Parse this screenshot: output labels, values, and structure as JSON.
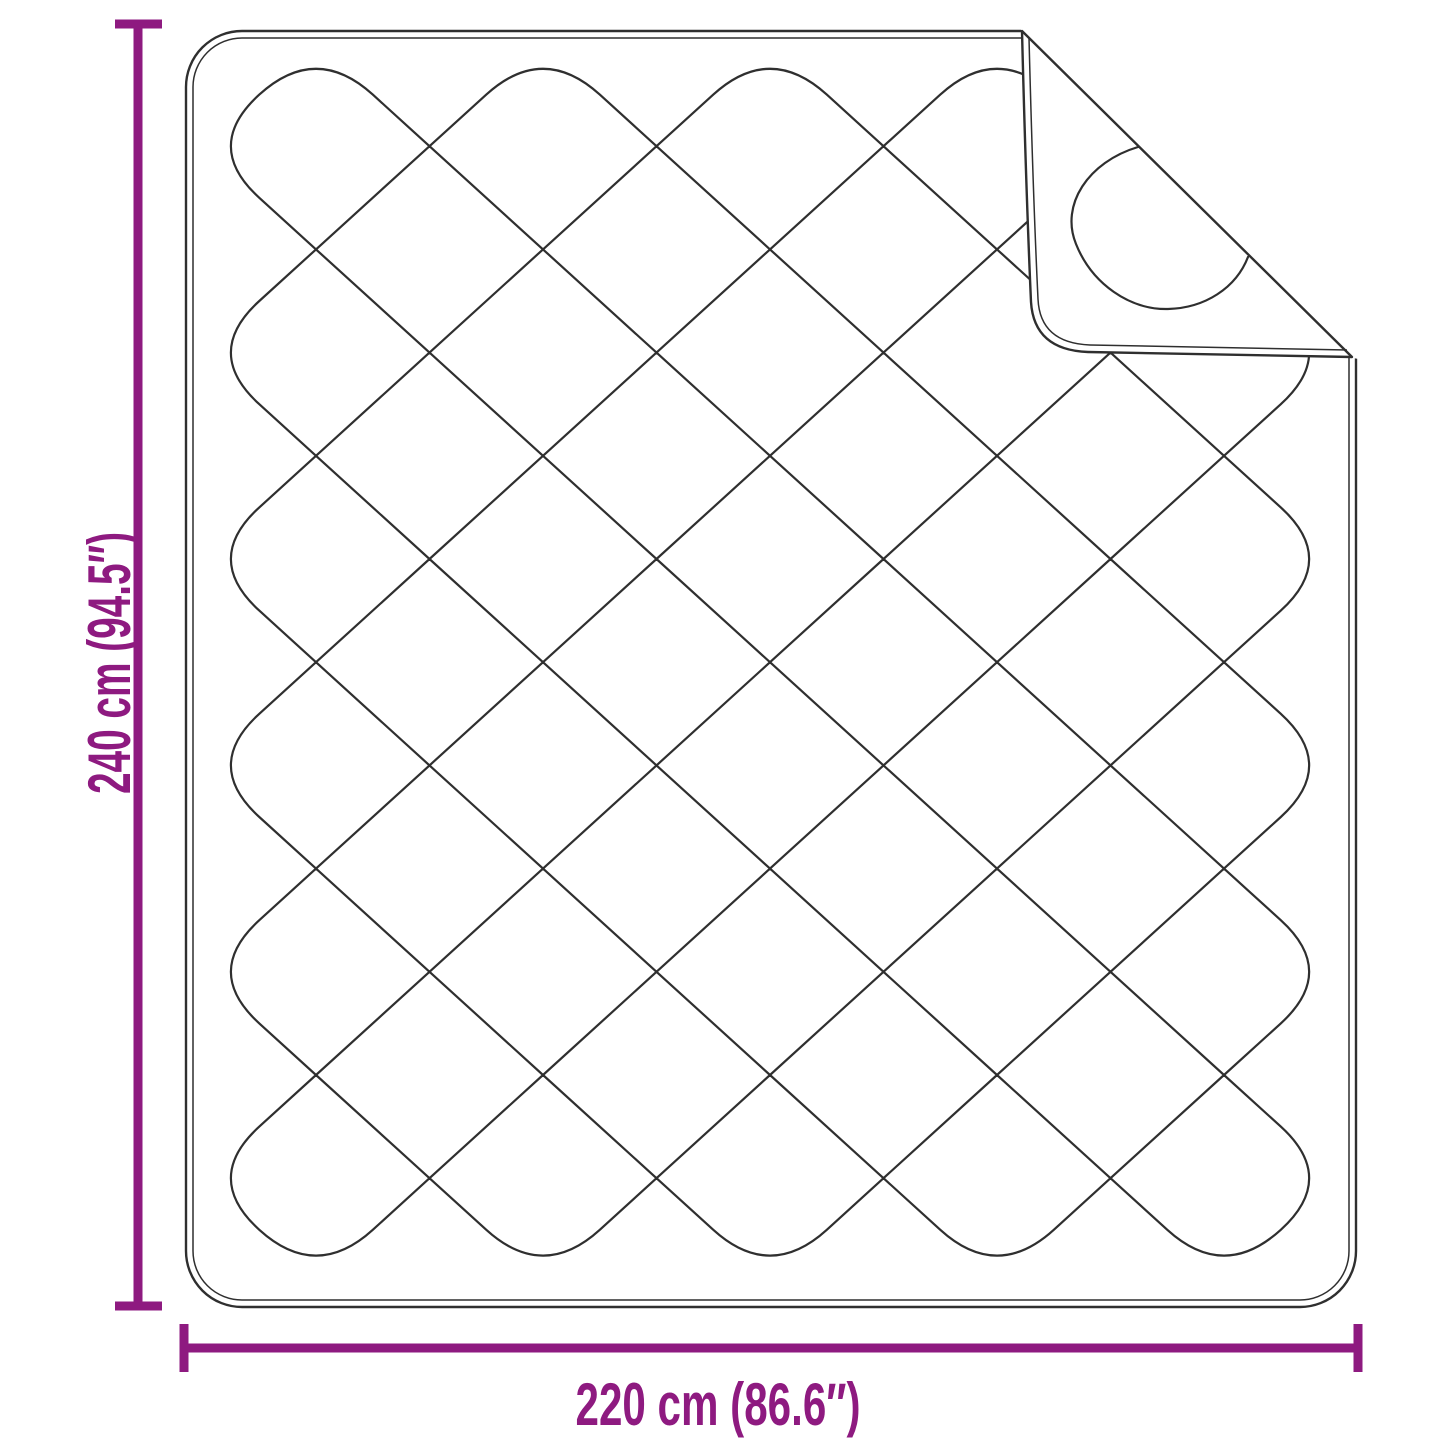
{
  "dimensions": {
    "height": {
      "label": "240 cm (94.5″)"
    },
    "width": {
      "label": "220 cm (86.6″)"
    }
  },
  "colors": {
    "accent": "#8e1a80",
    "line": "#2f2f2f",
    "background": "#ffffff"
  }
}
